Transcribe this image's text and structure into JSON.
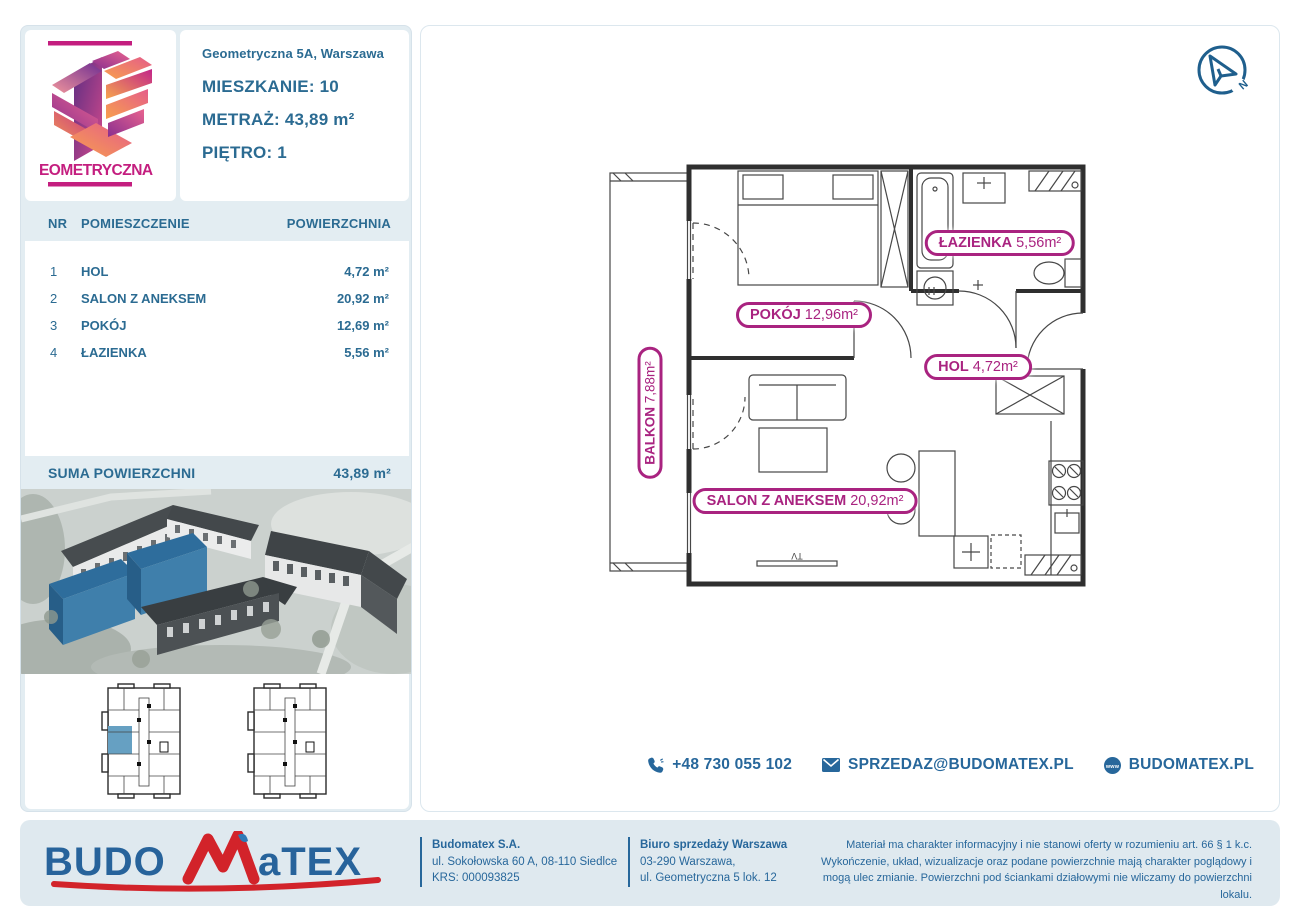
{
  "header": {
    "logo_text": "GEOMETRYCZNA",
    "address": "Geometryczna 5A, Warszawa",
    "apartment_label": "MIESZKANIE:",
    "apartment_value": "10",
    "area_label": "METRAŻ:",
    "area_value": "43,89 m²",
    "floor_label": "PIĘTRO:",
    "floor_value": "1"
  },
  "rooms_table": {
    "columns": [
      "NR",
      "POMIESZCZENIE",
      "POWIERZCHNIA"
    ],
    "rows": [
      {
        "nr": "1",
        "name": "HOL",
        "area": "4,72 m²"
      },
      {
        "nr": "2",
        "name": "SALON Z ANEKSEM",
        "area": "20,92 m²"
      },
      {
        "nr": "3",
        "name": "POKÓJ",
        "area": "12,69 m²"
      },
      {
        "nr": "4",
        "name": "ŁAZIENKA",
        "area": "5,56 m²"
      }
    ],
    "total_label": "SUMA POWIERZCHNI",
    "total_value": "43,89 m²"
  },
  "floor_plan": {
    "labels": [
      {
        "name": "ŁAZIENKA",
        "area": "5,56m²"
      },
      {
        "name": "POKÓJ",
        "area": "12,96m²"
      },
      {
        "name": "HOL",
        "area": "4,72m²"
      },
      {
        "name": "BALKON",
        "area": "7,88m²"
      },
      {
        "name": "SALON Z ANEKSEM",
        "area": "20,92m²"
      }
    ],
    "tv_label": "TV",
    "compass_label": "N"
  },
  "contact": {
    "phone": "+48 730 055 102",
    "email": "SPRZEDAZ@BUDOMATEX.PL",
    "website": "BUDOMATEX.PL"
  },
  "footer": {
    "brand_left": "BUDO",
    "brand_right": "aTEX",
    "company": {
      "name": "Budomatex S.A.",
      "address": "ul. Sokołowska 60 A, 08-110 Siedlce",
      "krs": "KRS: 000093825"
    },
    "office": {
      "name": "Biuro sprzedaży Warszawa",
      "line1": "03-290 Warszawa,",
      "line2": "ul. Geometryczna 5 lok. 12"
    },
    "disclaimer": "Materiał ma charakter informacyjny i nie stanowi oferty w rozumieniu art. 66 § 1 k.c. Wykończenie, układ, wizualizacje oraz podane powierzchnie mają charakter poglądowy i mogą ulec zmianie. Powierzchni pod ściankami działowymi nie wliczamy do powierzchni lokalu."
  },
  "colors": {
    "accent_blue": "#2b6b92",
    "accent_magenta": "#a92380",
    "panel_bg": "#e3edf2",
    "footer_bg": "#dfe9ef",
    "brand_red": "#d2232a",
    "highlight_blue": "#3f7fab"
  }
}
